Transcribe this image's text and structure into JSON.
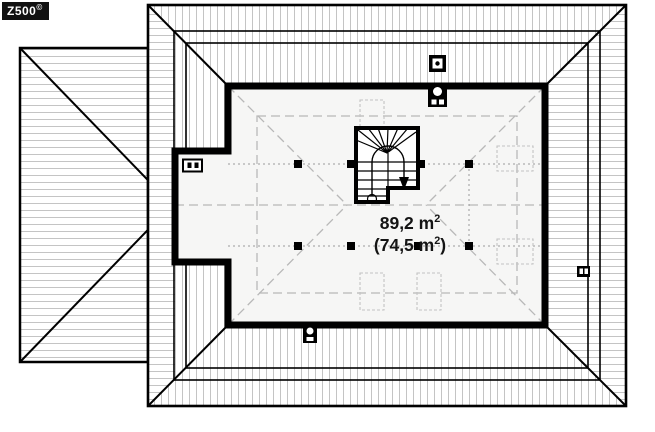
{
  "logo": {
    "text": "Z500",
    "sup": "©"
  },
  "room": {
    "area_gross_prefix": "89,2 m",
    "area_gross_sup": "2",
    "area_net_prefix": "(74,5 m",
    "area_net_sup": "2",
    "area_net_suffix": ")"
  },
  "colors": {
    "line": "#000000",
    "hatch": "#c4c4c4",
    "room_fill": "#f6f6f5",
    "dashed_guides": "#b8b8b8",
    "dotted_purlin": "#9a9a9a",
    "logo_bg": "#111111",
    "logo_text": "#ffffff",
    "label_text": "#141414"
  },
  "symbols": {
    "chimney_flue": "chimney-flue-icon",
    "ventilation_stack": "ventilation-stack-icon",
    "roof_vent_pair": "roof-vent-icon",
    "structural_post": "post-square",
    "skylight": "roof-window-dashed-rect",
    "staircase": "winder-staircase-down"
  }
}
